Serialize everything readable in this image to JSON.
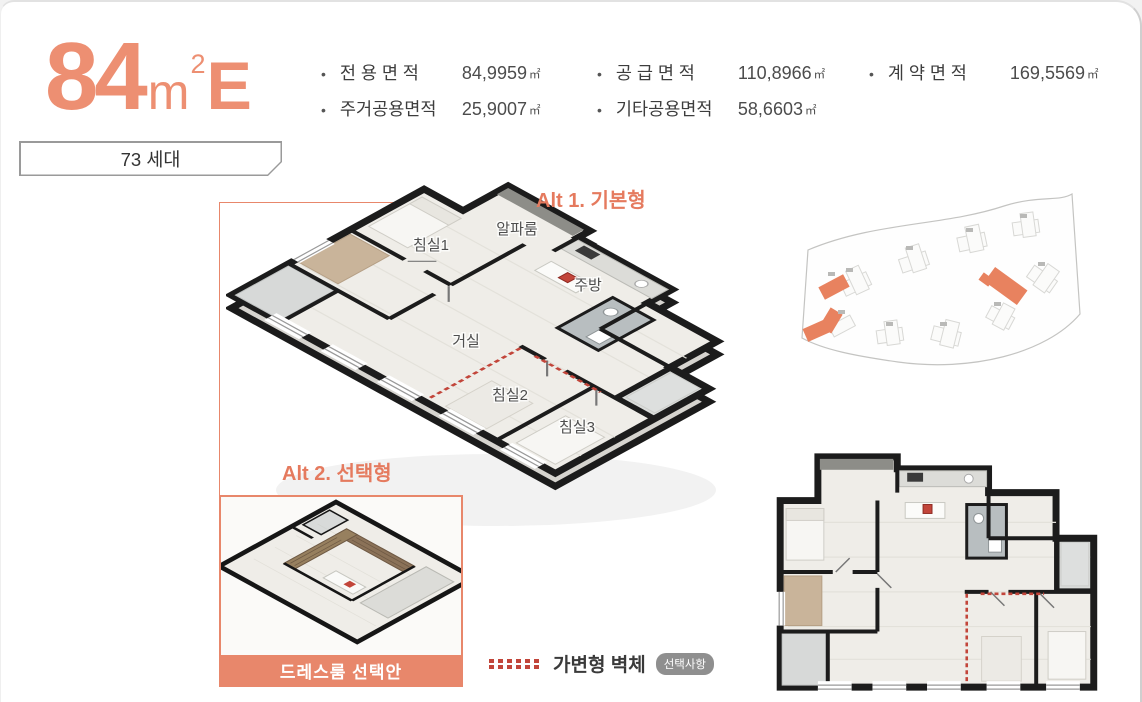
{
  "accent": "#E8876B",
  "title": {
    "number": "84",
    "unit": "m",
    "sup": "2",
    "type": "E"
  },
  "households_badge": "73 세대",
  "specs": {
    "bullet": "•",
    "items": [
      {
        "label": "전 용 면 적",
        "value": "84,9959",
        "unit": "㎡"
      },
      {
        "label": "공 급 면 적",
        "value": "110,8966",
        "unit": "㎡"
      },
      {
        "label": "계 약 면 적",
        "value": "169,5569",
        "unit": "㎡"
      },
      {
        "label": "주거공용면적",
        "value": "25,9007",
        "unit": "㎡"
      },
      {
        "label": "기타공용면적",
        "value": "58,6603",
        "unit": "㎡"
      }
    ]
  },
  "plan": {
    "alt1_label": "Alt 1. 기본형",
    "alt2_label": "Alt 2. 선택형",
    "rooms": {
      "alpha": "알파룸",
      "bed1": "침실1",
      "kitchen": "주방",
      "living": "거실",
      "bed2": "침실2",
      "bed3": "침실3"
    },
    "inset_caption": "드레스룸 선택안"
  },
  "legend": {
    "wall_label": "가변형 벽체",
    "badge": "선택사항"
  }
}
